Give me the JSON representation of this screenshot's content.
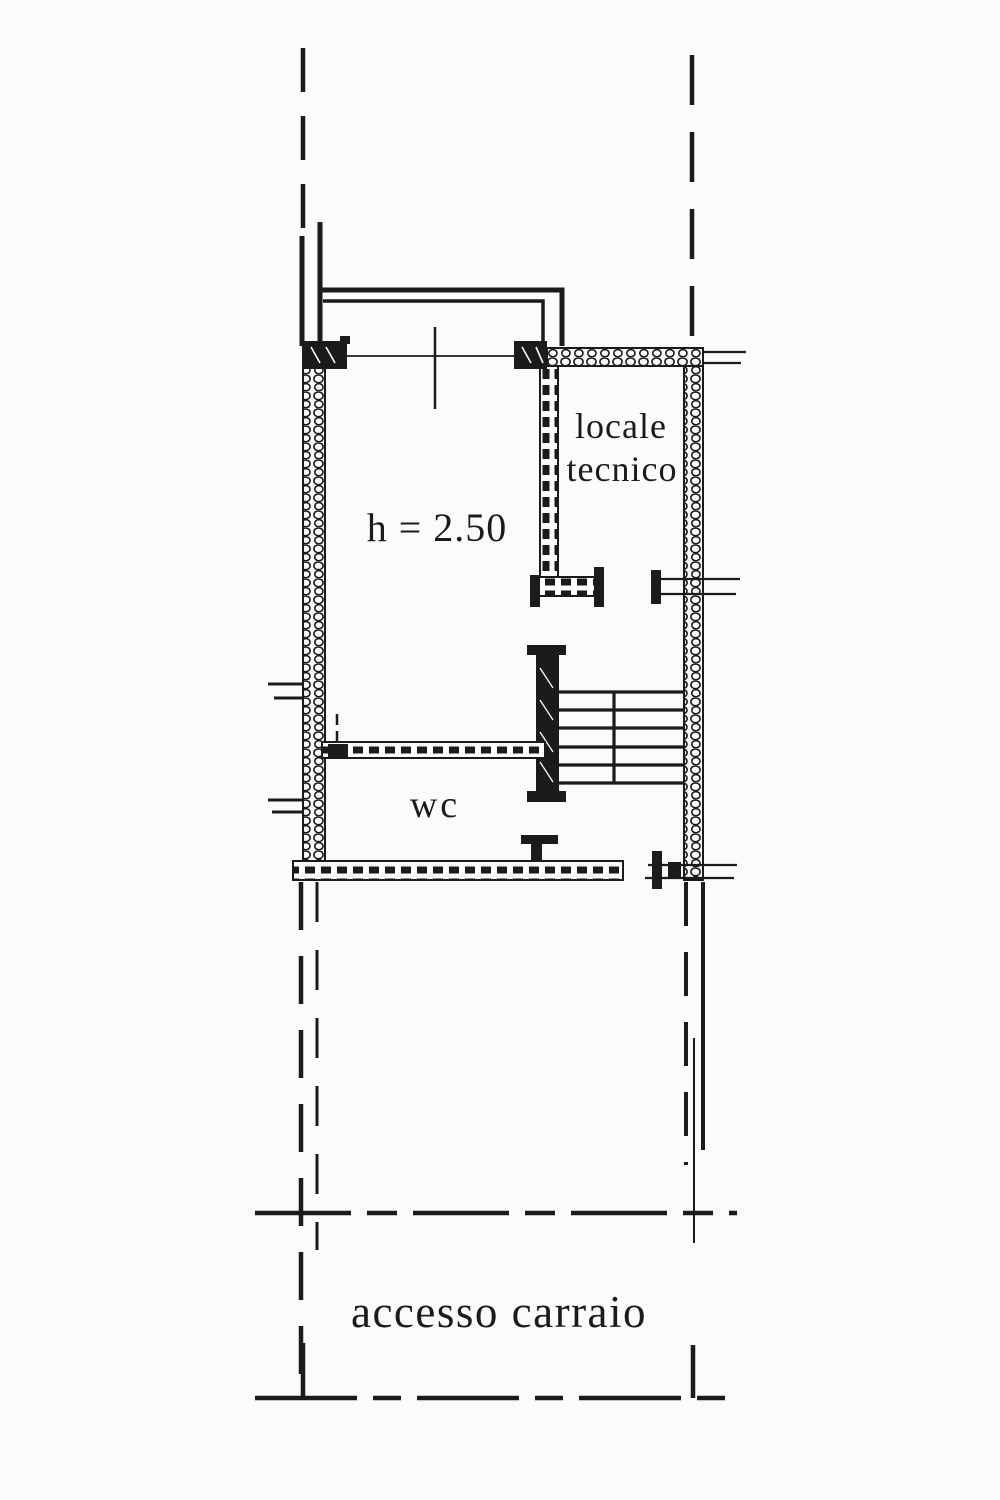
{
  "palette": {
    "paper": "#fbfbf9",
    "ink": "#1b1b1b"
  },
  "floor_plan": {
    "type": "cadastral-floor-plan",
    "rooms": [
      {
        "name": "main-room",
        "label": "h = 2.50"
      },
      {
        "name": "technical-room",
        "label_lines": [
          "locale",
          "tecnico"
        ]
      },
      {
        "name": "wc",
        "label": "wc"
      },
      {
        "name": "driveway",
        "label": "accesso carraio"
      }
    ]
  }
}
